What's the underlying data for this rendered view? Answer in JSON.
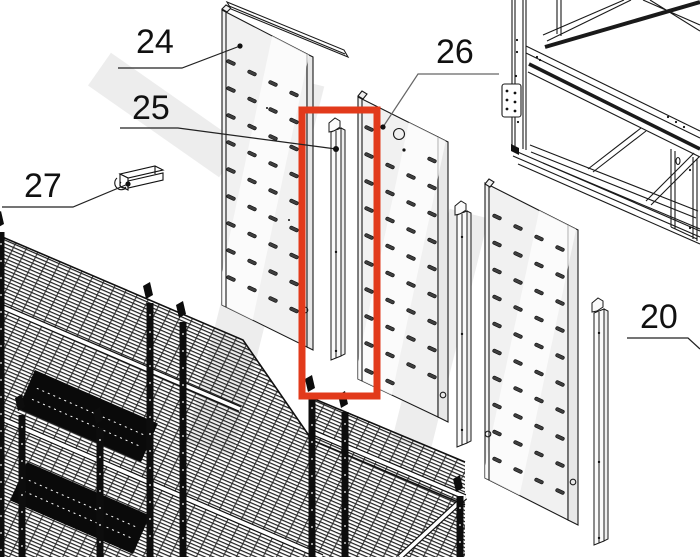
{
  "diagram": {
    "type": "exploded-parts-diagram",
    "highlight_color": "#e23a1b",
    "line_color": "#1a1a1a"
  },
  "callouts": [
    {
      "id": "part-24",
      "text": "24"
    },
    {
      "id": "part-25",
      "text": "25"
    },
    {
      "id": "part-26",
      "text": "26"
    },
    {
      "id": "part-27",
      "text": "27"
    },
    {
      "id": "part-20",
      "text": "20"
    }
  ]
}
